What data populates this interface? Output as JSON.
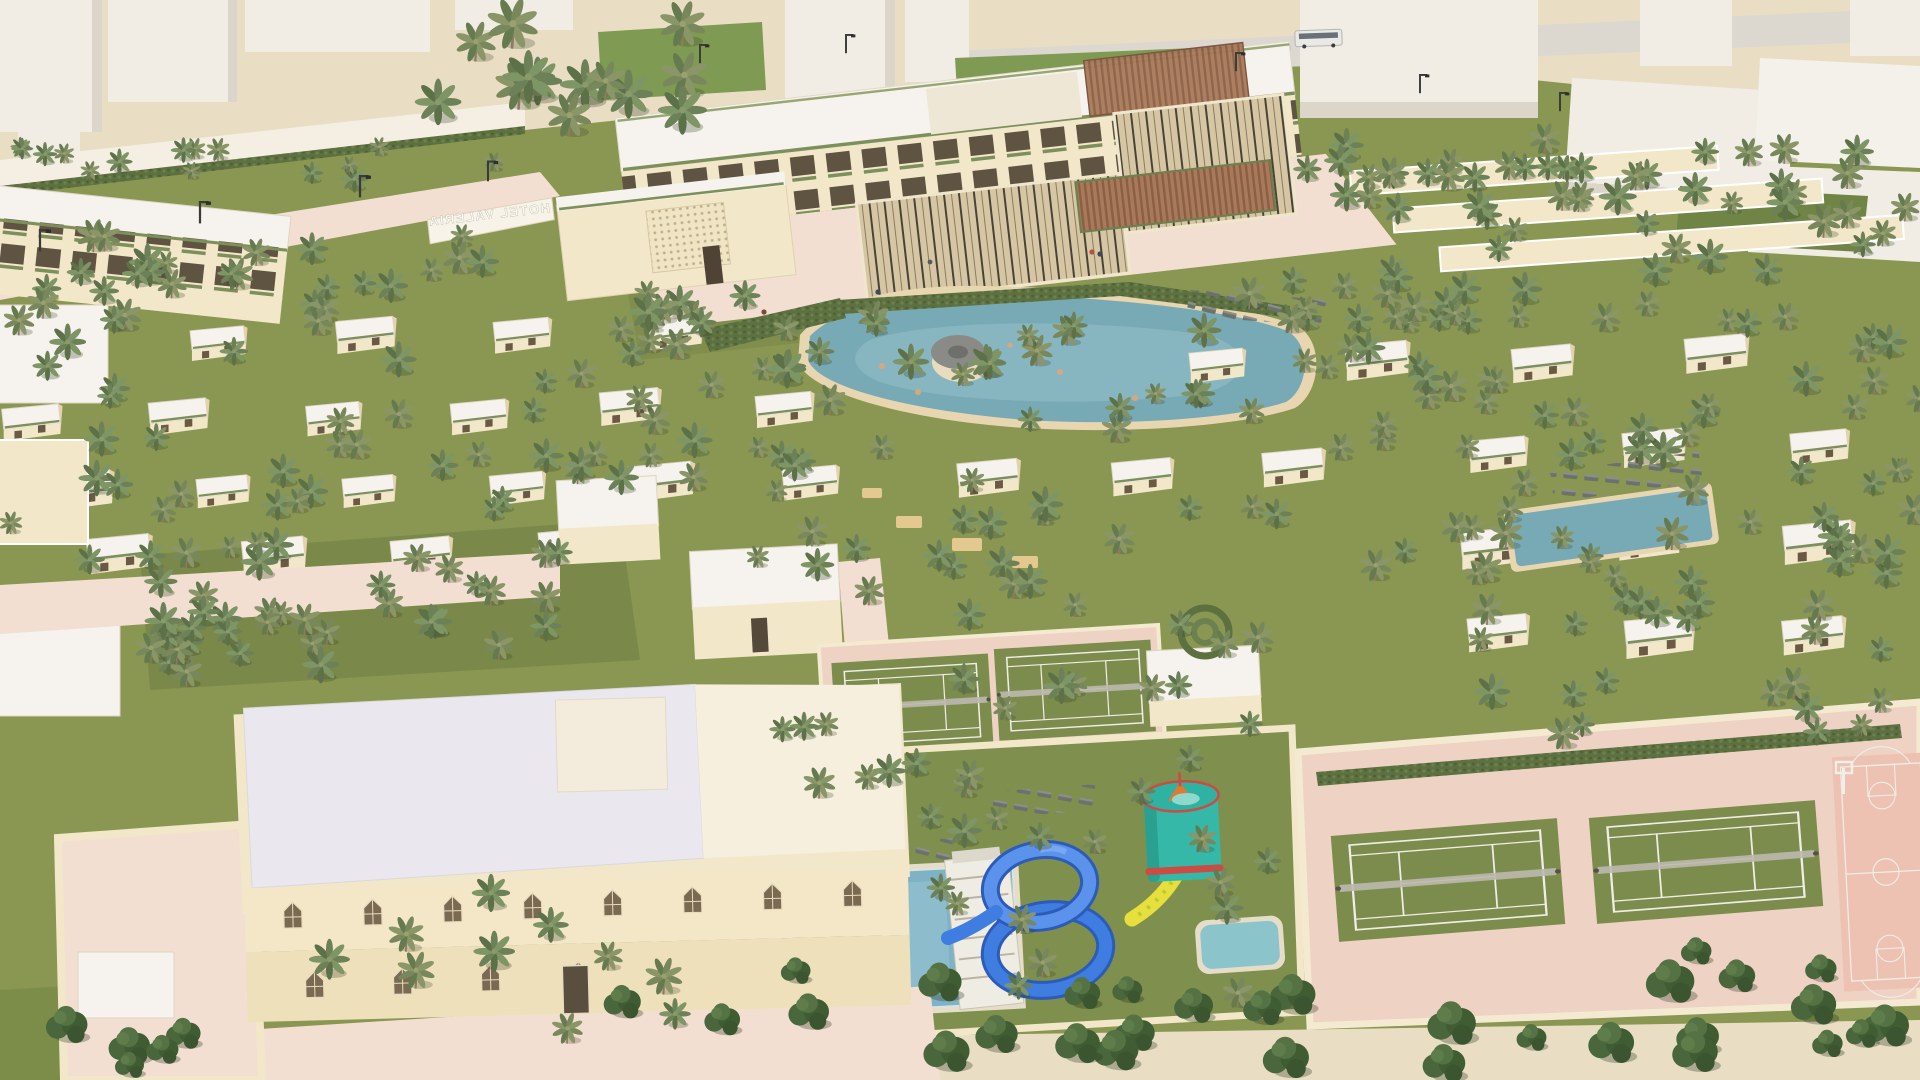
{
  "scene": {
    "kind": "3d-architectural-aerial-rendering",
    "subject": "palm resort masterplan",
    "sign": {
      "text": "HOTEL VALERIA",
      "mirrored_on_screen": true
    }
  },
  "palette": {
    "sand": "#e9dec4",
    "paving": "#f3dfd2",
    "pavingDeep": "#eed3c4",
    "wallCream": "#f2e7c9",
    "wallShade": "#e3d2ac",
    "roofWhite": "#f6f3ee",
    "roofLavender": "#eae7ee",
    "grass": "#8a9752",
    "grassDark": "#6d7c41",
    "palmA": "#6d8159",
    "palmB": "#7e9566",
    "treeDark": "#41603a",
    "poolTeal": "#78aab6",
    "poolLight": "#93c0c9",
    "aquaPool": "#7fb2c4",
    "slideBlue": "#3f7de0",
    "slideBlueDark": "#2c5cb8",
    "funnelTeal": "#35b8a8",
    "slideYellow": "#e6df3d",
    "funnelOrange": "#e07a32",
    "courtGreen": "#7c8c4c",
    "courtPink": "#edc2b2",
    "lineWhite": "#f0ede6",
    "contextWhite": "#f1ede5",
    "contextShade": "#dcd6ca",
    "road": "#dcd8d0",
    "pergola": "#a8795a",
    "glass": "#d6c6a4",
    "lounger": "#6d716c"
  },
  "features": [
    "context massing blocks",
    "perimeter road with street lamps",
    "hotel sign wall",
    "main hotel building with balconies",
    "rooftop terrace pergola",
    "glass lobby pavilion",
    "restaurant pergola terrace",
    "lagoon swimming pool",
    "swim-up pool bar",
    "sun loungers",
    "villa field with flat white roofs",
    "date palm groves",
    "central tennis courts",
    "aqua park pool",
    "blue spiral water slide",
    "stair tower",
    "teal funnel slide with yellow chute",
    "kids pool",
    "walled sports compound with two tennis courts",
    "pink basketball court",
    "banquet hall building with arched windows",
    "walled service yard",
    "street trees"
  ]
}
